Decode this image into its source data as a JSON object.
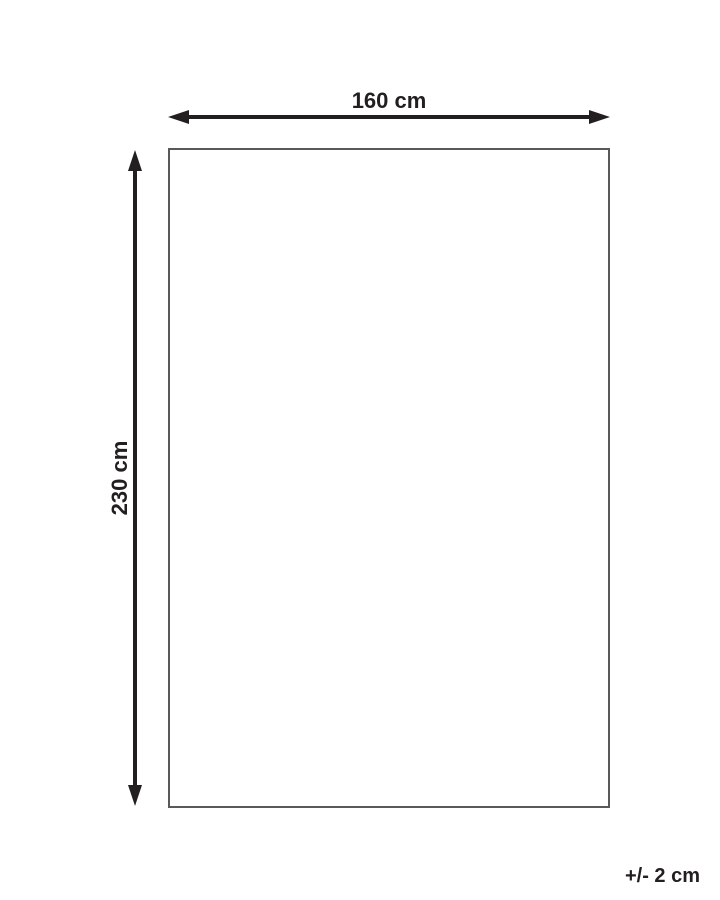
{
  "diagram": {
    "width_label": "160 cm",
    "height_label": "230 cm",
    "tolerance_label": "+/- 2 cm",
    "colors": {
      "arrow": "#231f20",
      "text": "#231f20",
      "outline": "#58595b",
      "background": "#ffffff"
    }
  }
}
